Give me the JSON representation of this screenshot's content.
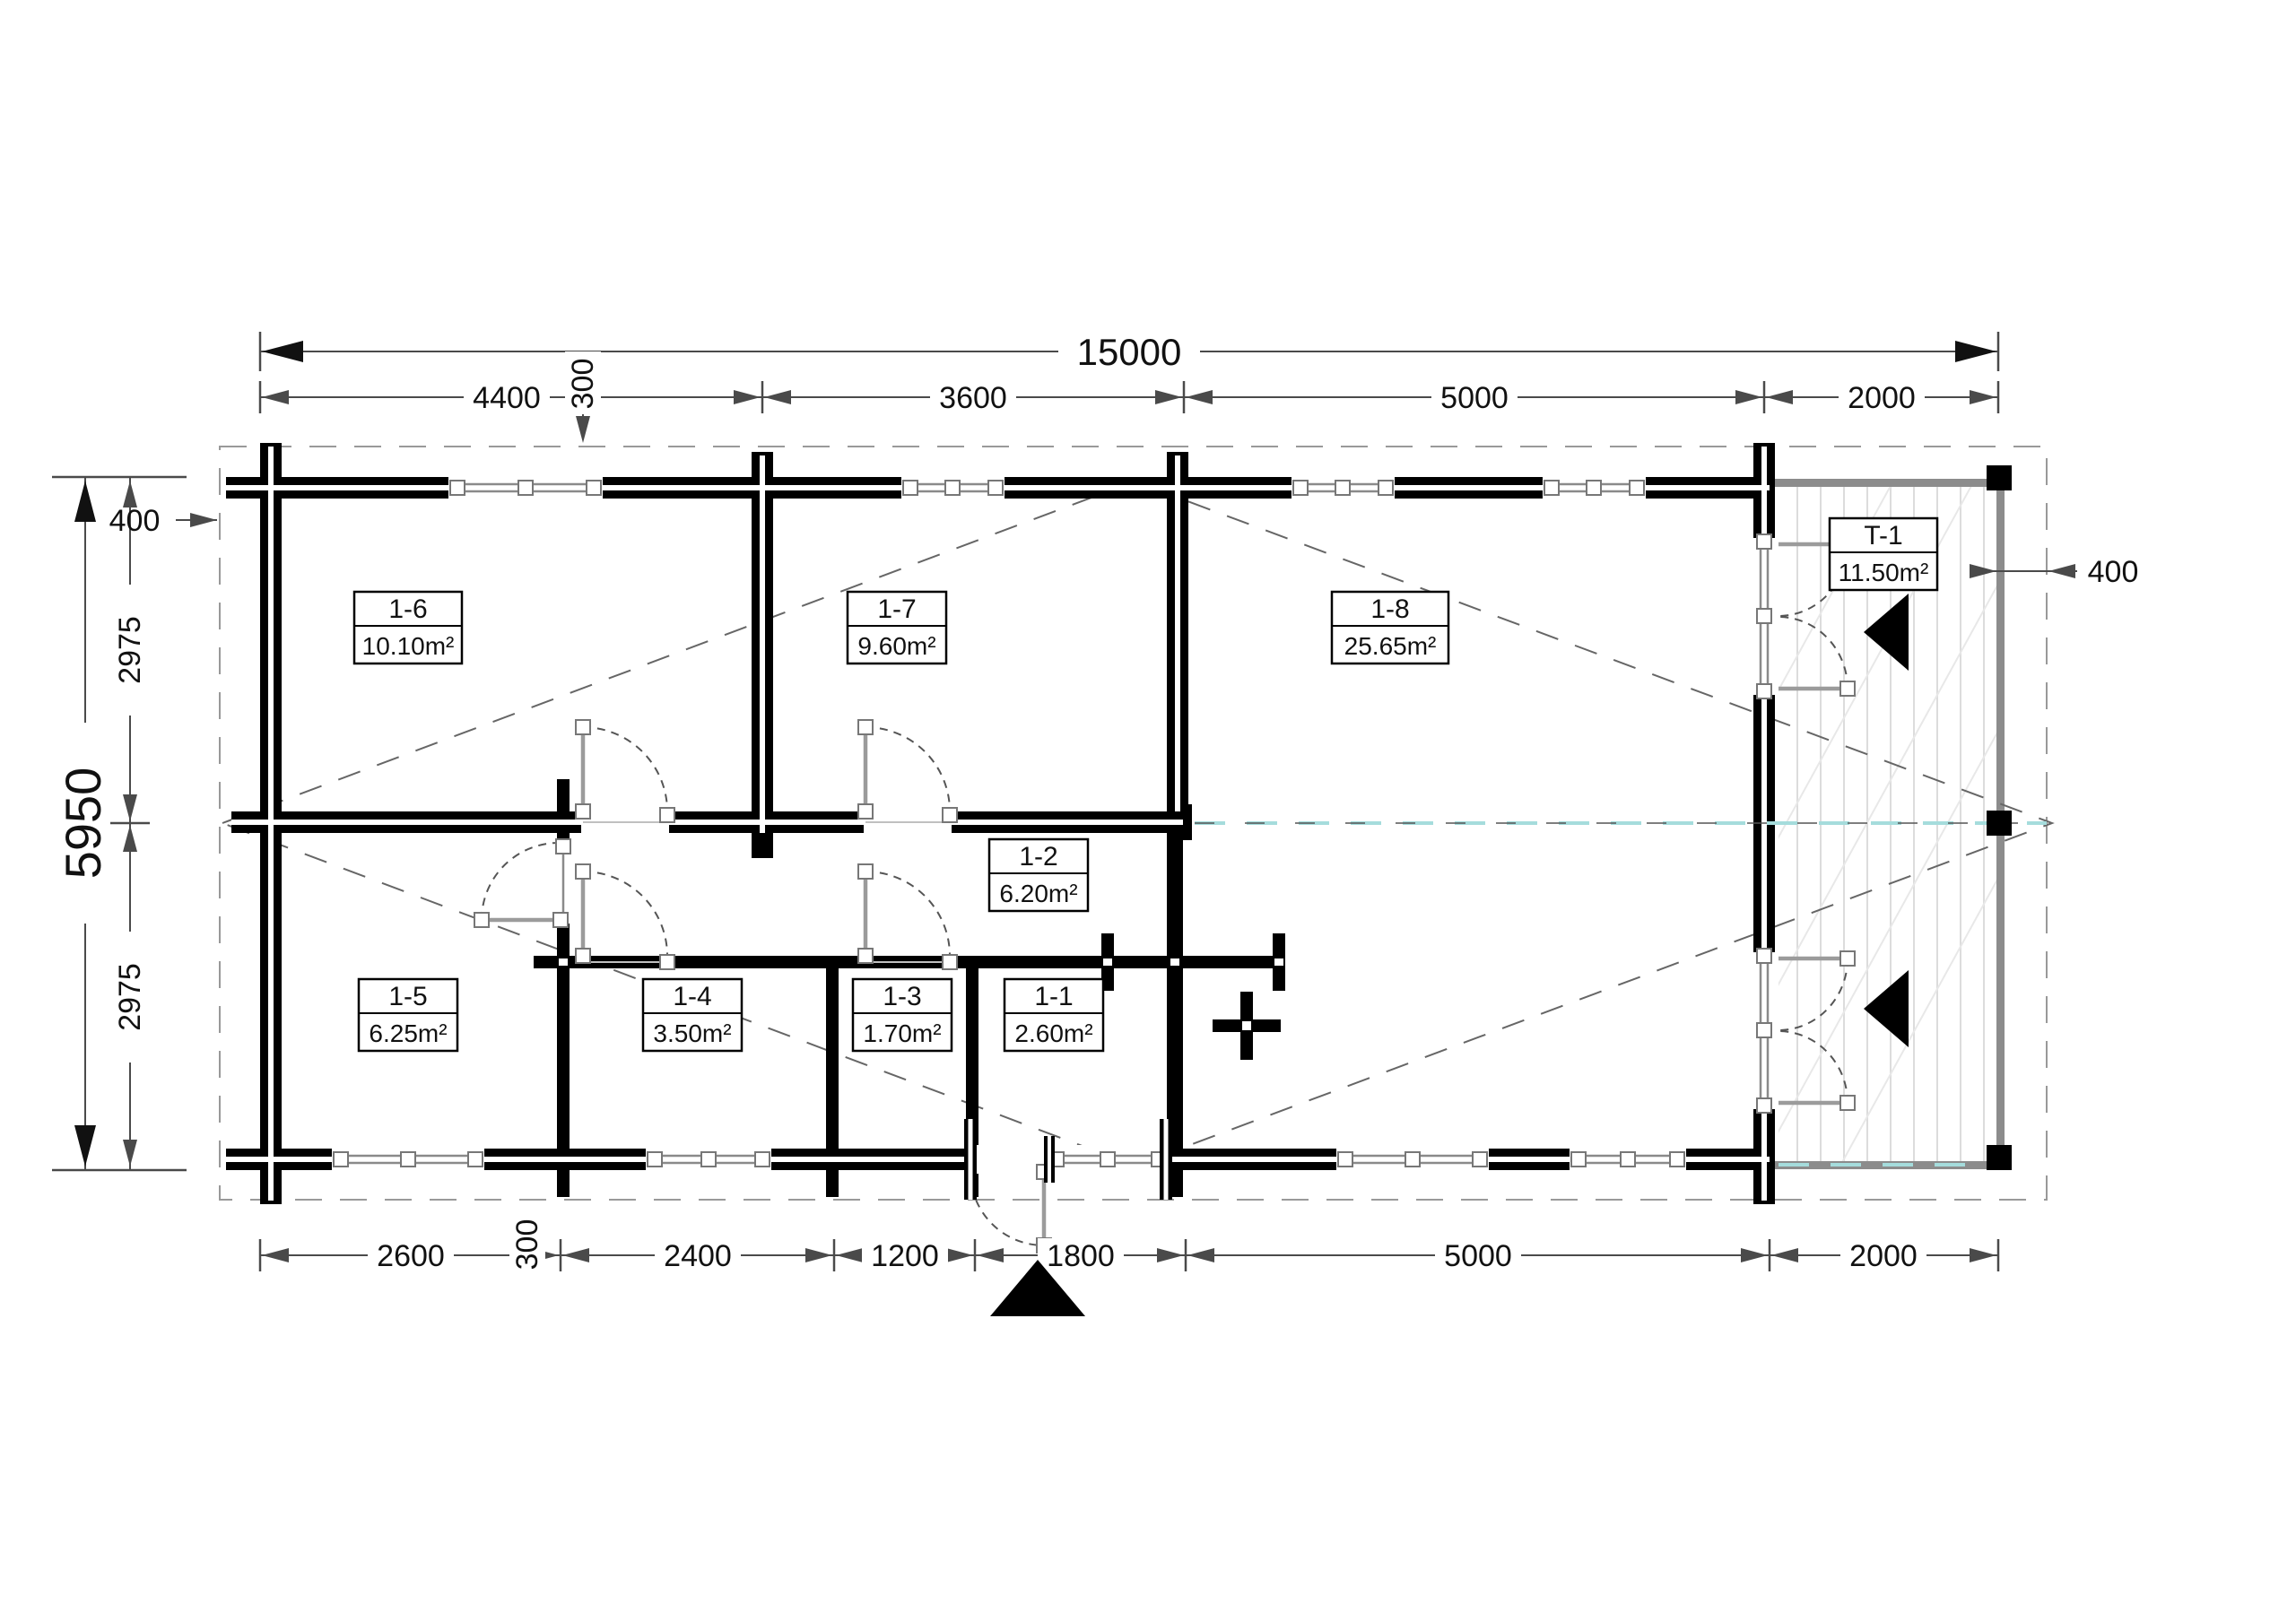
{
  "dimensions": {
    "overall_width": "15000",
    "overall_height": "5950",
    "top": [
      "4400",
      "300",
      "3600",
      "5000",
      "2000"
    ],
    "bottom": [
      "2600",
      "300",
      "2400",
      "1200",
      "1800",
      "5000",
      "2000"
    ],
    "left": [
      "2975",
      "2975"
    ],
    "overhang_left": "400",
    "overhang_right": "400"
  },
  "rooms": [
    {
      "id": "1-6",
      "area": "10.10m²"
    },
    {
      "id": "1-7",
      "area": "9.60m²"
    },
    {
      "id": "1-8",
      "area": "25.65m²"
    },
    {
      "id": "T-1",
      "area": "11.50m²"
    },
    {
      "id": "1-2",
      "area": "6.20m²"
    },
    {
      "id": "1-5",
      "area": "6.25m²"
    },
    {
      "id": "1-4",
      "area": "3.50m²"
    },
    {
      "id": "1-3",
      "area": "1.70m²"
    },
    {
      "id": "1-1",
      "area": "2.60m²"
    }
  ],
  "colors": {
    "wall": "#000000",
    "dimension": "#4a4a4a",
    "window": "#8a8a8a",
    "centerline": "#a5dcdc",
    "terrace_edge": "#8c8c8c"
  }
}
